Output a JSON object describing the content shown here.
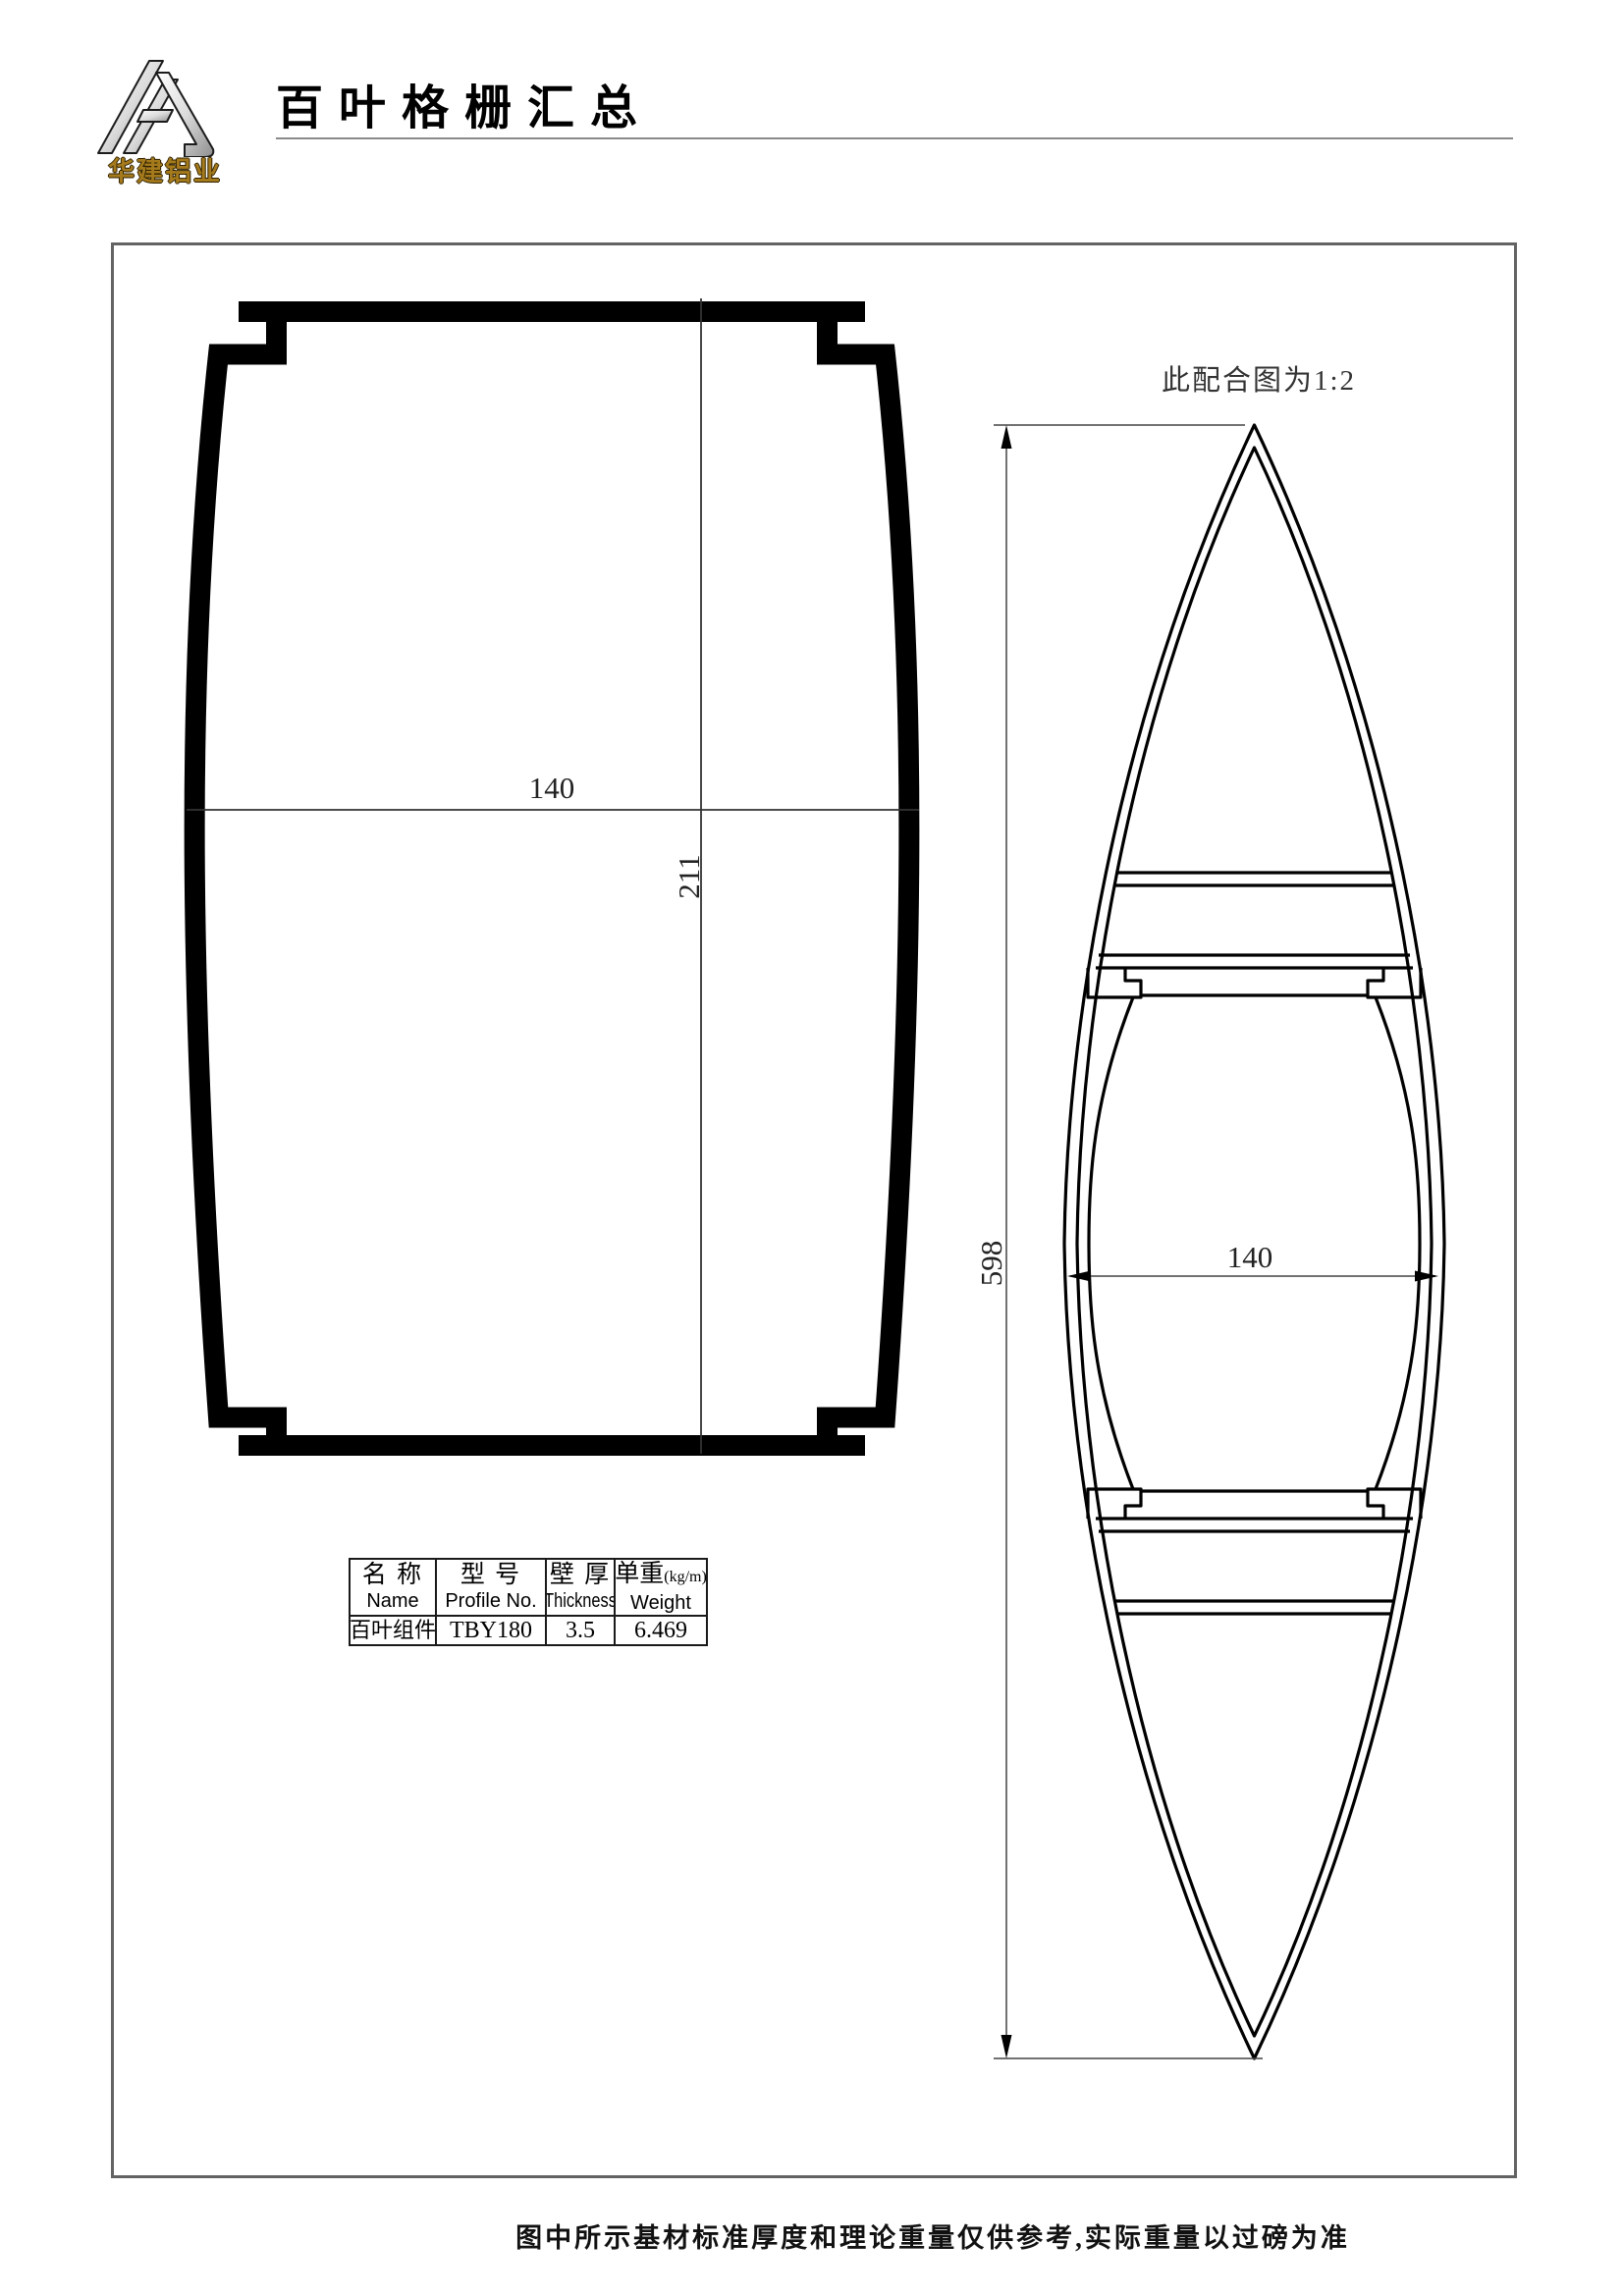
{
  "header": {
    "company_name": "华建铝业",
    "title": "百叶格栅汇总"
  },
  "drawing": {
    "scale_note": "此配合图为1:2",
    "left_profile": {
      "width_dim": "140",
      "height_dim": "211"
    },
    "right_profile": {
      "height_dim": "598",
      "width_dim": "140"
    }
  },
  "spec_table": {
    "col_name": {
      "zh": "名 称",
      "en": "Name"
    },
    "col_profile": {
      "zh": "型 号",
      "en": "Profile No."
    },
    "col_thickness": {
      "zh": "壁 厚",
      "en": "Thickness"
    },
    "col_weight": {
      "zh": "单重",
      "unit": "(kg/m)",
      "en": "Weight"
    },
    "row": {
      "name": "百叶组件",
      "profile_no": "TBY180",
      "thickness": "3.5",
      "weight": "6.469"
    }
  },
  "footer": {
    "note": "图中所示基材标准厚度和理论重量仅供参考,实际重量以过磅为准"
  }
}
